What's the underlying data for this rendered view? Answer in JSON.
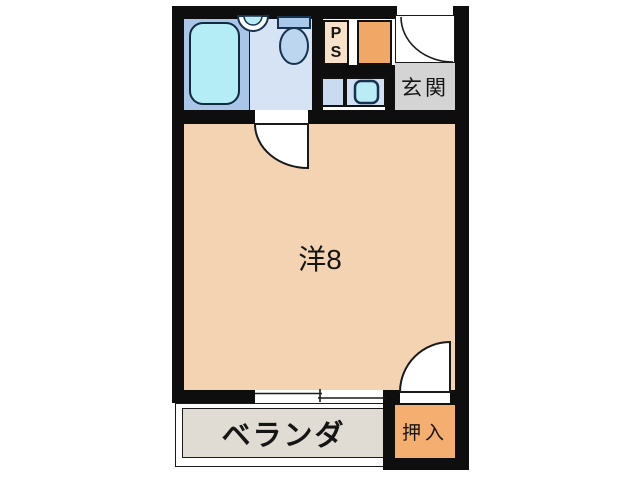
{
  "plan_title": "1R apartment floor plan",
  "rooms": {
    "main_room": {
      "label": "洋8"
    },
    "entrance": {
      "label": "玄関"
    },
    "veranda": {
      "label": "ベランダ"
    },
    "closet": {
      "label": "押入"
    },
    "pipe_space": {
      "label": "PS",
      "line1": "P",
      "line2": "S"
    }
  },
  "fixtures": [
    "bathtub-icon",
    "washbasin-icon",
    "toilet-icon",
    "washing-machine-pan-icon",
    "entrance-door-swing",
    "room-door-swing",
    "closet-door-swing",
    "sliding-window"
  ],
  "colors": {
    "wall": "#0e0e0e",
    "main_room": "#f4d3b2",
    "pipe_space": "#f7e1c8",
    "service_box": "#f1a765",
    "closet": "#f4ae70",
    "entrance_floor": "#d4d4d4",
    "veranda_floor": "#e0dcd3",
    "bath_floor": "#a9c6e9",
    "toilet_floor": "#d6e3f5",
    "bathtub": "#b4edf6",
    "toilet": "#a9c9eb",
    "sink": "#baecf5",
    "washbox_left": "#c9daf1",
    "washbox_right": "#d2e0f4"
  }
}
